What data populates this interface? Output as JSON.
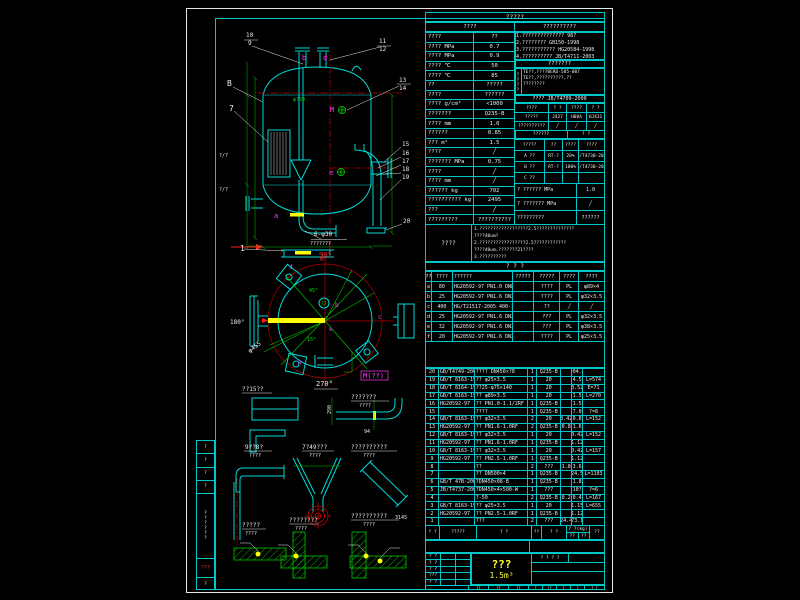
{
  "colors": {
    "line_cyan": "#00c8c8",
    "dim_green": "#00d200",
    "center_red": "#c80000",
    "text_white": "#ececec",
    "highlight_yellow": "#ffff00",
    "nozzle_magenta": "#ff3cff",
    "background": "#000000"
  },
  "left_margin": {
    "rows": [
      "?",
      "?",
      "?",
      "?"
    ],
    "vertical_text": "??????",
    "red_stamp": "???",
    "foot": "?"
  },
  "tech": {
    "title": "?????",
    "header_left": "????",
    "header_right": "??????????",
    "rows": [
      [
        "????",
        "??"
      ],
      [
        "???? MPa",
        "0.7"
      ],
      [
        "???? MPa",
        "0.9"
      ],
      [
        "???? ℃",
        "50"
      ],
      [
        "???? ℃",
        "85"
      ],
      [
        "??",
        "?????"
      ],
      [
        "????",
        "??????"
      ],
      [
        "???? g/cm³",
        "<1000"
      ],
      [
        "???????",
        "Q235-B"
      ],
      [
        "???? mm",
        "1.0"
      ],
      [
        "??????",
        "0.85"
      ],
      [
        "??? m³",
        "1.5"
      ],
      [
        "????",
        "╱"
      ],
      [
        "??????? MPa",
        "0.75"
      ],
      [
        "????",
        "╱"
      ],
      [
        "???? mm",
        "╱"
      ],
      [
        "?????? kg",
        "702"
      ],
      [
        "?????????? kg",
        "2495"
      ],
      [
        "???",
        "╱"
      ],
      [
        "?????????",
        "??????????"
      ]
    ],
    "notes1": [
      "1.?????????????? 98?",
      "2.???????? GB150-1998",
      "3.??????????? HG20584-1998",
      "4.?????????? JB/T4711-2003"
    ],
    "mid_header": "???????",
    "notes2_side": "????",
    "notes2": [
      "TE??,????BERD-505-007",
      "TE??,??????????,??",
      "????????"
    ],
    "std_row": "???? JB/T4709-2000",
    "weld": {
      "corner_top": "? ?",
      "corner_bottom": "????",
      "rows": [
        [
          "????",
          "? ?",
          "????",
          "? ?"
        ],
        [
          "?????",
          "J427",
          "H08A",
          "HJ431"
        ],
        [
          "??????????",
          "╱",
          "╱",
          "╱"
        ]
      ]
    },
    "extra_row": [
      "??????",
      "? ?"
    ],
    "ndt_rows": [
      [
        "?????",
        "??",
        "????",
        "????"
      ],
      [
        "A ??",
        "RT-?",
        "20%",
        "JB/T4730-2005"
      ],
      [
        "B ??",
        "RT-?",
        "100%",
        "JB/T4730-2005"
      ],
      [
        "C ??",
        "",
        "",
        ""
      ]
    ],
    "press_rows": [
      [
        "? ?????? MPa",
        "1.0"
      ],
      [
        "? ??????? MPa",
        "╱"
      ],
      [
        "?????????",
        "??????"
      ]
    ]
  },
  "notes_block": {
    "label": "????",
    "lines": [
      "1.??????????????????2.5??????????????",
      "????40um?",
      "2.?????????????????2.5????????????",
      "????40um,???????21????",
      "3.??????????"
    ]
  },
  "gap_title": "?  ?  ?",
  "nozzle": {
    "header": [
      [
        "??",
        "????",
        "??????",
        "?????",
        "?????",
        "????",
        "????"
      ]
    ],
    "rows": [
      [
        "a",
        "80",
        "HG20592-97 PN1.0 DN80 RF",
        "",
        "????",
        "PL",
        "φ89×4"
      ],
      [
        "b",
        "25",
        "HG20592-97 PN1.6 DN25 RF",
        "",
        "????",
        "PL",
        "φ32×3.5"
      ],
      [
        "c",
        "400",
        "HG/T21517-2005 400-1.0",
        "",
        "??",
        "╱",
        "╱"
      ],
      [
        "d",
        "25",
        "HG20592-97 PN1.6 DN25 RF",
        "",
        "???",
        "PL",
        "φ32×3.5"
      ],
      [
        "e",
        "32",
        "HG20592-97 PN1.6 DN32 RF",
        "",
        "???",
        "PL",
        "φ38×3.5"
      ],
      [
        "f",
        "20",
        "HG20592-97 PN1.6 DN20 RF",
        "",
        "????",
        "PL",
        "φ25×3.5"
      ]
    ]
  },
  "bom": {
    "header": {
      "no": "? ?",
      "std": "?????",
      "name": "?  ?",
      "qty": "??",
      "mat": "?  ?",
      "wt_top": "? ?(kg)",
      "wt_a": "??",
      "wt_b": "??",
      "rem": "??"
    },
    "rows": [
      [
        "20",
        "GB/T4749-2005",
        "???? DN450×?8",
        "1",
        "Q235-B",
        "",
        "304.4",
        ""
      ],
      [
        "19",
        "GB/T 8163-1999",
        "?? φ25×3.5",
        "1",
        "20",
        "",
        "4.5",
        "L=574"
      ],
      [
        "18",
        "GB/T 8164-1993",
        "??25-φ75×140",
        "1",
        "20",
        "",
        "3.52",
        "E=71"
      ],
      [
        "17",
        "GB/T 8163-1999",
        "?? φ89×3.5",
        "1",
        "20",
        "",
        "1.5",
        "L=270"
      ],
      [
        "16",
        "HG20592-97",
        "?? PN1.0-1.1/2RF",
        "1",
        "Q235-B",
        "",
        "1.5",
        ""
      ],
      [
        "15",
        "",
        "????",
        "1",
        "Q235-B",
        "",
        "7.0",
        "?=8"
      ],
      [
        "14",
        "GB/T 8163-1999",
        "?? φ32×3.5",
        "2",
        "20",
        "0.42",
        "0.8",
        "L=152"
      ],
      [
        "13",
        "HG20592-97",
        "?? PN1.6-1.0RF",
        "2",
        "Q235-B",
        "0.8",
        "1.6",
        ""
      ],
      [
        "12",
        "GB/T 8163-1999",
        "?? φ32×3.5",
        "1",
        "20",
        "",
        "0.42",
        "L=152"
      ],
      [
        "11",
        "HG20592-97",
        "?? PN1.6-1.0RF",
        "1",
        "Q235-B",
        "",
        "1.12",
        ""
      ],
      [
        "10",
        "GB/T 8163-1999",
        "?? φ32×3.5",
        "1",
        "20",
        "",
        "0.42",
        "L=157"
      ],
      [
        "9",
        "HG20592-97",
        "?? PN2.5-1.0RF",
        "1",
        "Q235-B",
        "",
        "1.12",
        ""
      ],
      [
        "8",
        "",
        "??",
        "2",
        "???",
        "1.8",
        "3.6",
        ""
      ],
      [
        "7",
        "",
        "?? DN500×4",
        "1",
        "Q235-B",
        "",
        "24.5",
        "L=1103"
      ],
      [
        "6",
        "GB/T 47B-2002",
        "?DN450×08-B",
        "1",
        "Q235-B",
        "",
        "1.8",
        ""
      ],
      [
        "5",
        "JB/T4737-2002",
        "?DN450×4×500-W",
        "1",
        "???",
        "",
        "10?",
        "?=6"
      ],
      [
        "4",
        "",
        "?-50",
        "2",
        "Q235-B",
        "0.2",
        "0.4",
        "L=167"
      ],
      [
        "3",
        "GB/T 8163-1999",
        "?? φ25×3.5",
        "1",
        "20",
        "",
        "1.15",
        "L=655"
      ],
      [
        "2",
        "HG20592-97",
        "?? PN2.5-1.0RF",
        "1",
        "Q235-B",
        "",
        "1.12",
        ""
      ],
      [
        "1",
        "",
        "???",
        "2",
        "???",
        "24.4",
        "73.1",
        ""
      ]
    ]
  },
  "title_block": {
    "sig_rows": [
      [
        "? ?",
        "",
        ""
      ],
      [
        "? ?",
        "",
        ""
      ],
      [
        "? ?",
        "",
        ""
      ],
      [
        "???",
        "",
        ""
      ],
      [
        "? ?",
        "",
        ""
      ]
    ],
    "product_name": "???",
    "capacity": "1.5m³",
    "right_header": "? ? ? ?",
    "bottom_cells": [
      "??",
      "??",
      "??",
      "?",
      "??",
      "?",
      "?",
      "? ?"
    ]
  },
  "drawing": {
    "front": {
      "labels": [
        {
          "t": "10",
          "x": 246,
          "y": 37
        },
        {
          "t": "9",
          "x": 248,
          "y": 45
        },
        {
          "t": "11",
          "x": 379,
          "y": 43
        },
        {
          "t": "12",
          "x": 379,
          "y": 51
        },
        {
          "t": "B",
          "x": 227,
          "y": 86,
          "s": 8
        },
        {
          "t": "7",
          "x": 229,
          "y": 111,
          "s": 8
        },
        {
          "t": "13",
          "x": 399,
          "y": 82
        },
        {
          "t": "14",
          "x": 399,
          "y": 90
        },
        {
          "t": "15",
          "x": 402,
          "y": 146
        },
        {
          "t": "16",
          "x": 402,
          "y": 155
        },
        {
          "t": "17",
          "x": 402,
          "y": 163
        },
        {
          "t": "18",
          "x": 402,
          "y": 171
        },
        {
          "t": "19",
          "x": 402,
          "y": 179
        },
        {
          "t": "20",
          "x": 403,
          "y": 223
        },
        {
          "t": "1",
          "x": 240,
          "y": 251,
          "s": 8
        },
        {
          "t": "6-φ30",
          "x": 314,
          "y": 236,
          "s": 6
        },
        {
          "t": "???????",
          "x": 310,
          "y": 245,
          "s": 5
        },
        {
          "t": "90°",
          "x": 319,
          "y": 257,
          "c": "r",
          "s": 7
        },
        {
          "t": "φ?30",
          "x": 293,
          "y": 101,
          "c": "g",
          "s": 5
        },
        {
          "t": "b",
          "x": 302,
          "y": 60,
          "c": "m",
          "s": 7
        },
        {
          "t": "d",
          "x": 323,
          "y": 60,
          "c": "m",
          "s": 7
        },
        {
          "t": "M",
          "x": 330,
          "y": 112,
          "c": "m",
          "s": 7
        },
        {
          "t": "e",
          "x": 329,
          "y": 175,
          "c": "m",
          "s": 7
        },
        {
          "t": "a",
          "x": 274,
          "y": 218,
          "c": "m",
          "s": 7
        },
        {
          "t": "?/?",
          "x": 219,
          "y": 157,
          "s": 5
        },
        {
          "t": "?/?",
          "x": 219,
          "y": 191,
          "s": 5
        }
      ]
    },
    "plan": {
      "labels": [
        {
          "t": "0°",
          "x": 320,
          "y": 261,
          "c": "r",
          "s": 6
        },
        {
          "t": "180°",
          "x": 230,
          "y": 324,
          "s": 6
        },
        {
          "t": "270°",
          "x": 316,
          "y": 386,
          "s": 7
        },
        {
          "t": "45°",
          "x": 309,
          "y": 292,
          "c": "g",
          "s": 5
        },
        {
          "t": "15°",
          "x": 307,
          "y": 341,
          "c": "g",
          "s": 5
        },
        {
          "t": "φ455",
          "x": 250,
          "y": 353,
          "s": 6,
          "r": -38
        },
        {
          "t": "M(??)",
          "x": 363,
          "y": 378,
          "c": "m",
          "s": 7
        },
        {
          "t": "d",
          "x": 289,
          "y": 269,
          "c": "m",
          "s": 6
        },
        {
          "t": "b",
          "x": 335,
          "y": 307,
          "c": "m",
          "s": 6
        },
        {
          "t": "e",
          "x": 329,
          "y": 331,
          "c": "m",
          "s": 6
        },
        {
          "t": "a",
          "x": 298,
          "y": 364,
          "c": "m",
          "s": 6
        },
        {
          "t": "c",
          "x": 378,
          "y": 319,
          "c": "m",
          "s": 6
        }
      ]
    },
    "details": {
      "labels": [
        {
          "t": "??15??",
          "x": 242,
          "y": 391,
          "s": 6
        },
        {
          "t": "???????",
          "x": 351,
          "y": 399,
          "s": 6
        },
        {
          "t": "????",
          "x": 359,
          "y": 407,
          "s": 5
        },
        {
          "t": "290",
          "x": 331,
          "y": 414,
          "s": 5,
          "r": -90
        },
        {
          "t": "94",
          "x": 364,
          "y": 433,
          "s": 5
        },
        {
          "t": "9??8?",
          "x": 245,
          "y": 449,
          "s": 6
        },
        {
          "t": "????",
          "x": 249,
          "y": 457,
          "s": 5
        },
        {
          "t": "7?49???",
          "x": 302,
          "y": 449,
          "s": 6
        },
        {
          "t": "????",
          "x": 309,
          "y": 457,
          "s": 5
        },
        {
          "t": "??????????",
          "x": 351,
          "y": 449,
          "s": 6
        },
        {
          "t": "????",
          "x": 363,
          "y": 457,
          "s": 5
        },
        {
          "t": "3145",
          "x": 395,
          "y": 519,
          "s": 5
        },
        {
          "t": "?????",
          "x": 242,
          "y": 527,
          "s": 6
        },
        {
          "t": "????",
          "x": 245,
          "y": 535,
          "s": 5
        },
        {
          "t": "????????",
          "x": 289,
          "y": 522,
          "s": 6
        },
        {
          "t": "????",
          "x": 295,
          "y": 530,
          "s": 5
        },
        {
          "t": "??????????",
          "x": 351,
          "y": 518,
          "s": 6
        },
        {
          "t": "????",
          "x": 363,
          "y": 526,
          "s": 5
        }
      ]
    }
  }
}
